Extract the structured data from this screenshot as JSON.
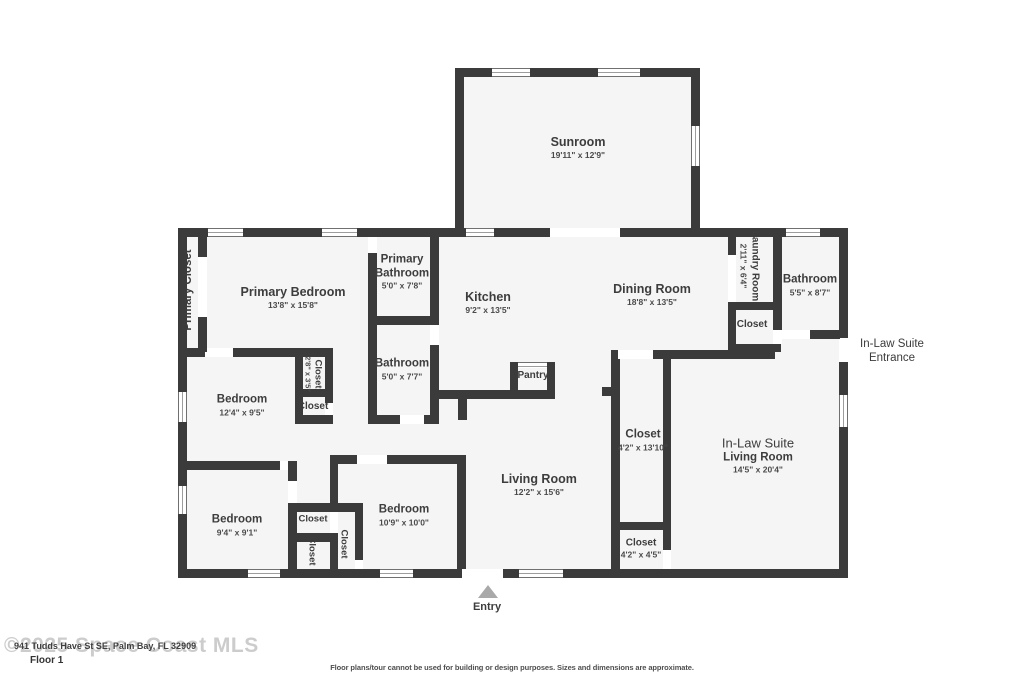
{
  "rooms": {
    "sunroom": {
      "name": "Sunroom",
      "dims": "19'11\" x 12'9\""
    },
    "primary_closet": {
      "name": "Primary Closet"
    },
    "primary_bedroom": {
      "name": "Primary Bedroom",
      "dims": "13'8\" x 15'8\""
    },
    "primary_bathroom": {
      "name": "Primary Bathroom",
      "dims": "5'0\" x 7'8\""
    },
    "kitchen": {
      "name": "Kitchen",
      "dims": "9'2\" x 13'5\""
    },
    "dining_room": {
      "name": "Dining Room",
      "dims": "18'8\" x 13'5\""
    },
    "laundry_room": {
      "name": "Laundry Room",
      "dims": "2'11\" x 6'4\""
    },
    "laundry_closet": {
      "name": "Closet"
    },
    "bathroom_inlaw": {
      "name": "Bathroom",
      "dims": "5'5\" x 8'7\""
    },
    "closet_hall_small": {
      "name": "Closet",
      "dims": "2'8\" x 3'5\""
    },
    "closet_hall": {
      "name": "Closet"
    },
    "bathroom_hall": {
      "name": "Bathroom",
      "dims": "5'0\" x 7'7\""
    },
    "pantry": {
      "name": "Pantry"
    },
    "bedroom_mid": {
      "name": "Bedroom",
      "dims": "12'4\" x 9'5\""
    },
    "living_room": {
      "name": "Living Room",
      "dims": "12'2\" x 15'6\""
    },
    "closet_inlaw_tall": {
      "name": "Closet",
      "dims": "4'2\" x 13'10\""
    },
    "inlaw_living": {
      "line1": "In-Law Suite",
      "line2": "Living Room",
      "dims": "14'5\" x 20'4\""
    },
    "closet_inlaw_small": {
      "name": "Closet",
      "dims": "4'2\" x 4'5\""
    },
    "bedroom_bl": {
      "name": "Bedroom",
      "dims": "9'4\" x 9'1\""
    },
    "closet_bl_h": {
      "name": "Closet"
    },
    "closet_bl_v1": {
      "name": "Closet"
    },
    "closet_bl_v2": {
      "name": "Closet"
    },
    "bedroom_bottom": {
      "name": "Bedroom",
      "dims": "10'9\" x 10'0\""
    }
  },
  "annotations": {
    "entry": "Entry",
    "inlaw_entrance_line1": "In-Law Suite",
    "inlaw_entrance_line2": "Entrance"
  },
  "footer": {
    "watermark": "©2025 Space Coast MLS",
    "address": "941 Tudds Have St SE, Palm Bay, FL 32909",
    "floor_label": "Floor 1",
    "disclaimer": "Floor plans/tour cannot be used for building or design purposes. Sizes and dimensions are approximate."
  },
  "colors": {
    "wall": "#3b3b3b",
    "floor": "#f5f5f5",
    "text": "#3d3d3d",
    "watermark": "#cccccc",
    "entry_arrow": "#a9a9a9"
  }
}
